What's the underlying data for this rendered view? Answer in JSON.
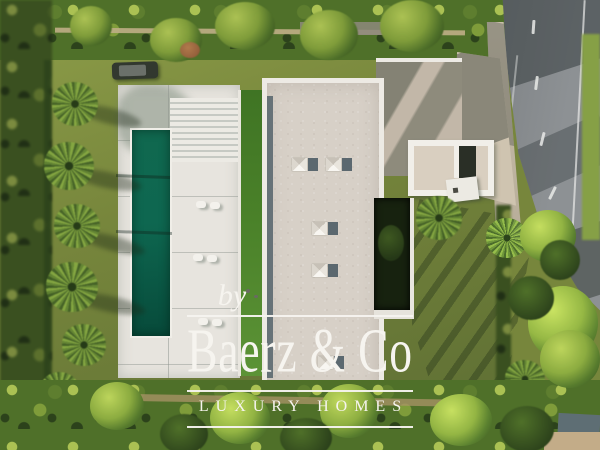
{
  "watermark": {
    "prefix": "by",
    "brand": "Baerz & Co",
    "tagline": "LUXURY HOMES"
  },
  "palette": {
    "foliage-dark": "#2c421b",
    "foliage-mid": "#4f7029",
    "foliage-mid2": "#5e7e2f",
    "foliage-light": "#7f9c3a",
    "foliage-sun": "#abc153",
    "lawn": "#77863c",
    "lawn-sun": "#97a94d",
    "lawn-shade": "#5c6d33",
    "pool": "#0e6750",
    "pool-dark": "#074a3a",
    "deck": "#e7e4de",
    "strip-green": "#4a8129",
    "roof": "#d7d0c7",
    "roof-edge": "#edeae4",
    "roof-glass": "#5b686f",
    "concrete": "#cfc4b0",
    "concrete-shade": "#958f80",
    "road": "#8d9194",
    "road-shade": "#596063",
    "road-line": "#e9eae8",
    "court-dark": "#17220f",
    "car": "#32382f",
    "rust": "#95603c",
    "structure-roof": "#5e6e74",
    "structure-wall": "#c3ac88",
    "wall-tan": "#bfae86",
    "watermark": "#f6f4ef"
  }
}
